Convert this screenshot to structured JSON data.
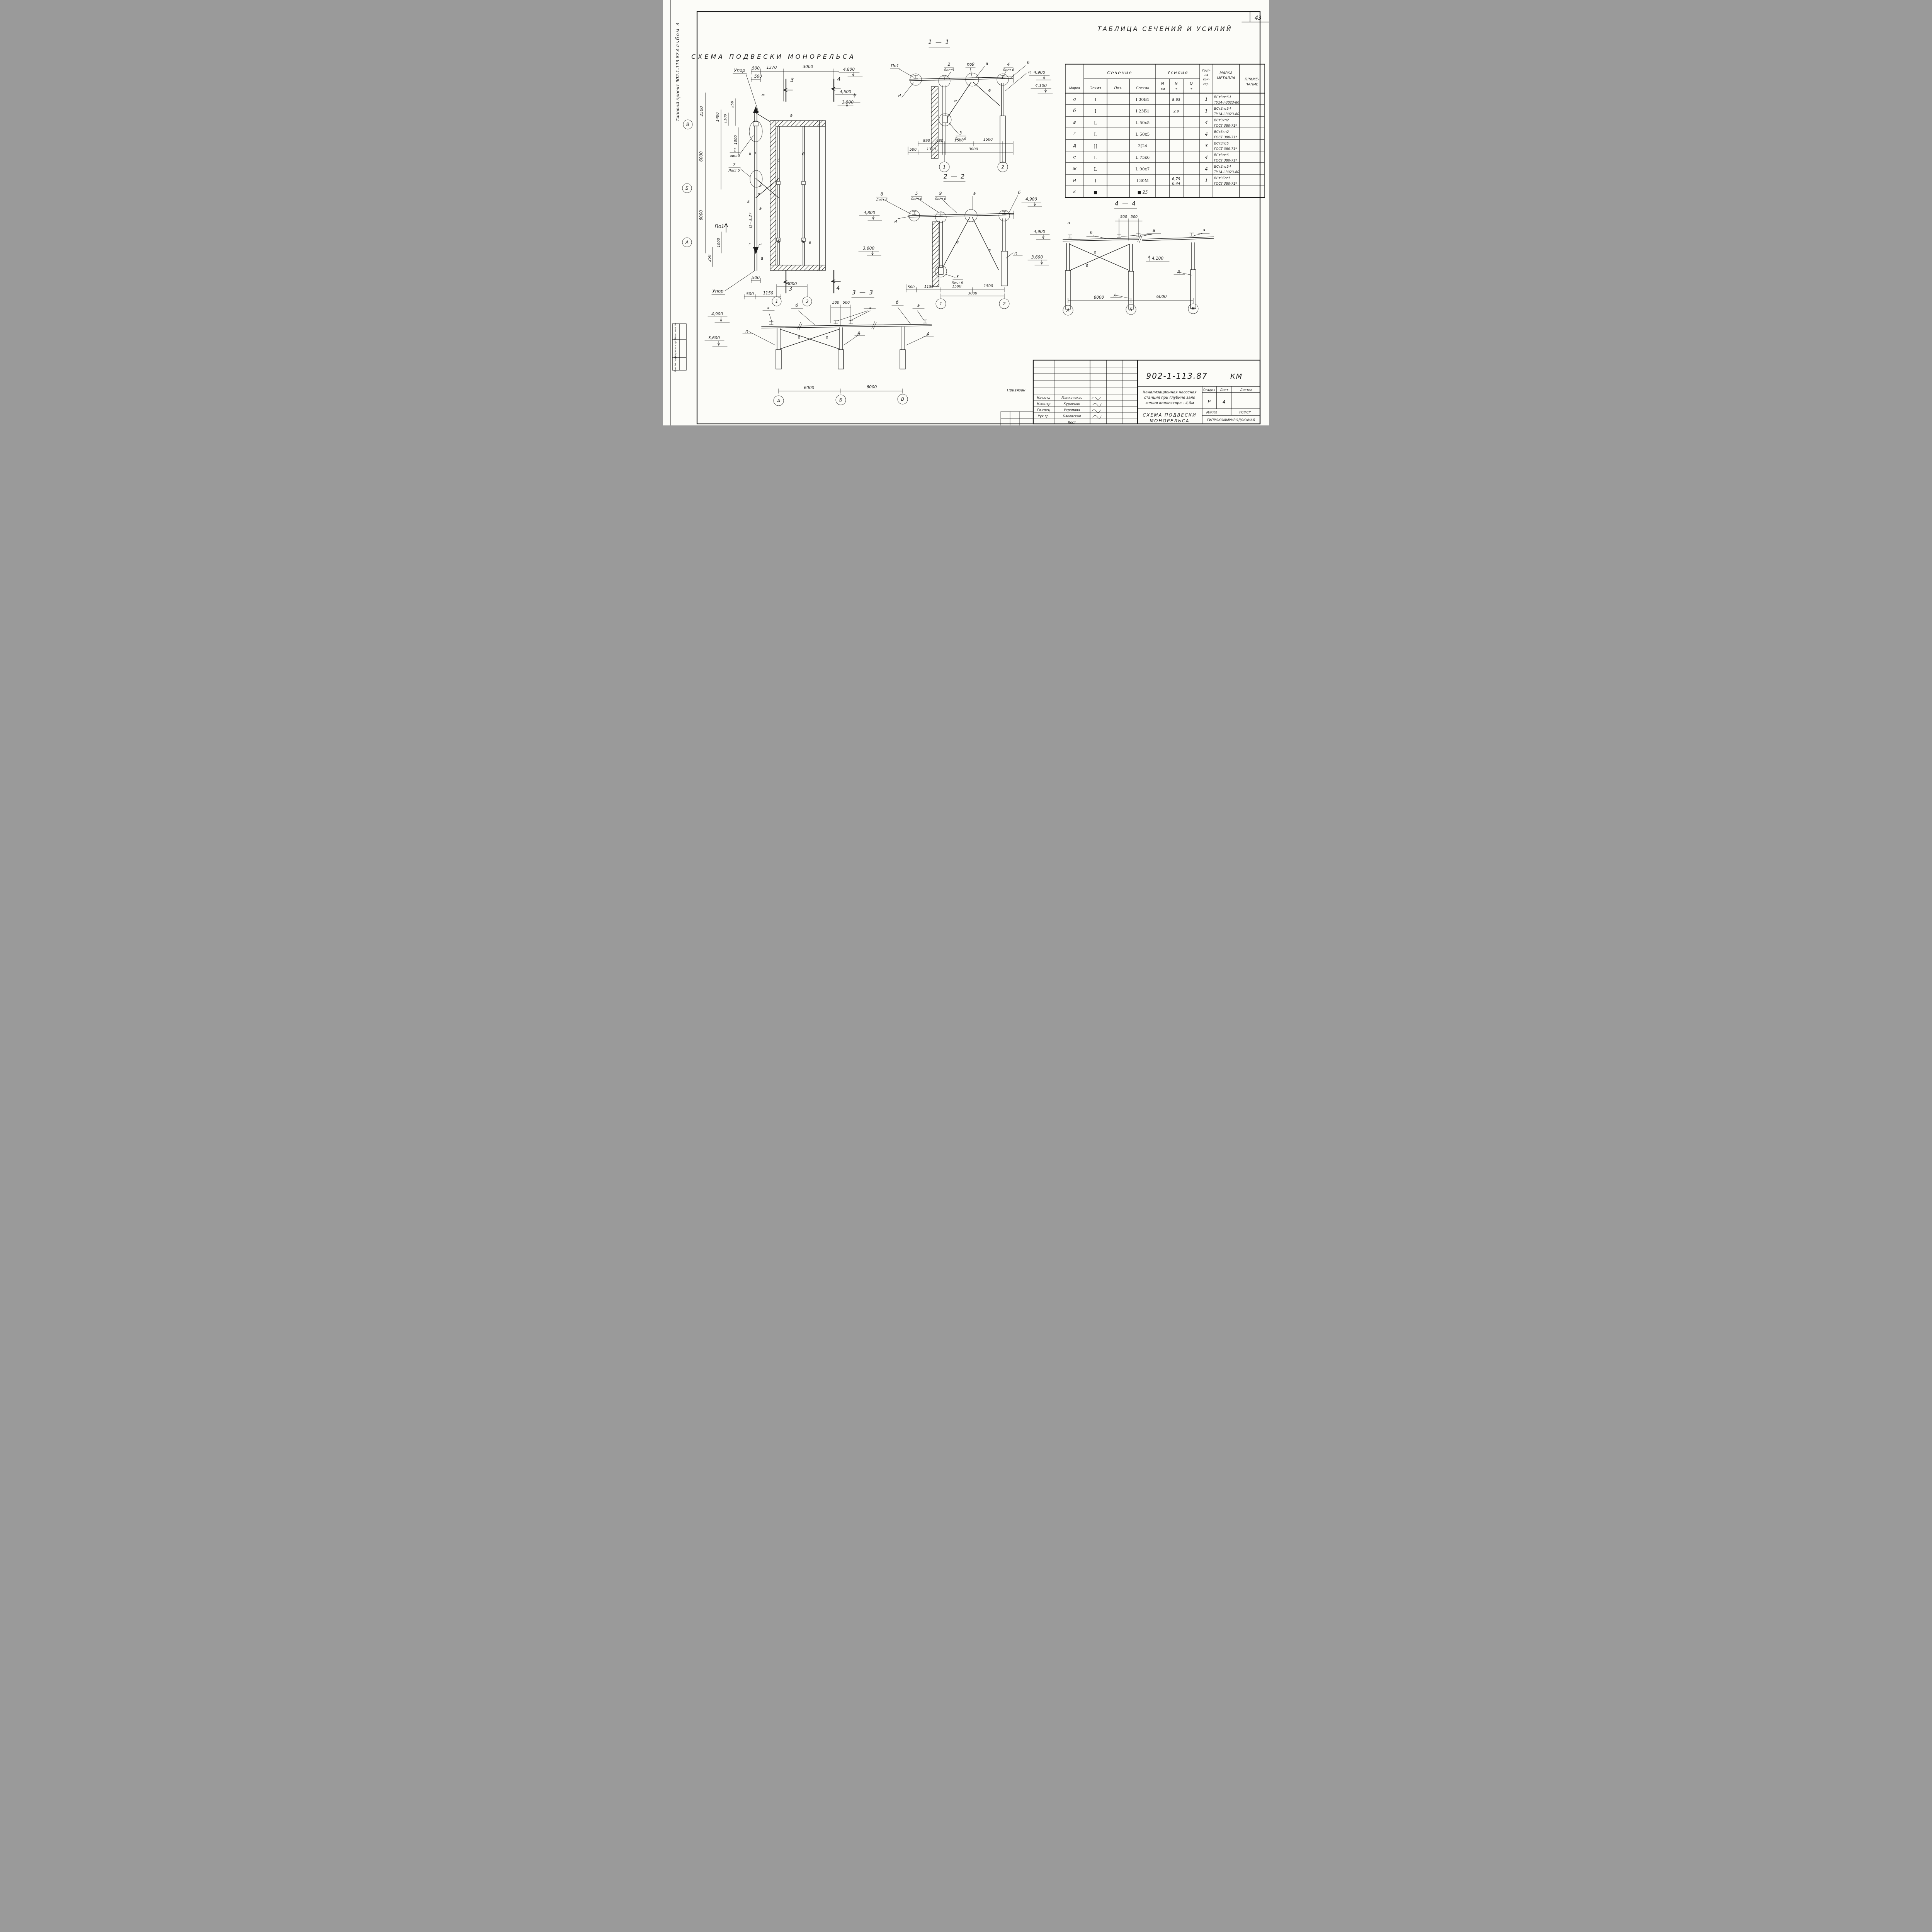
{
  "page": {
    "sheet_number": "43"
  },
  "side": {
    "project": "Типовой проект 902-1-113.87",
    "album": "Альбом 3",
    "stamp_cells": [
      "Взам. инв. №",
      "Подпись и дата",
      "Инв. № подл."
    ]
  },
  "table": {
    "title": "ТАБЛИЦА СЕЧЕНИЙ И УСИЛИЙ",
    "headers": {
      "marka": "Марка",
      "sechenie": "Сечение",
      "usiliya": "Усилия",
      "eskiz": "Эскиз",
      "poz": "Поз.",
      "sostav": "Состав",
      "m": "М",
      "m_u": "тм",
      "n": "N",
      "n_u": "т",
      "q": "Q",
      "q_u": "т",
      "grp1": "Груп-",
      "grp2": "па",
      "grp3": "кон-",
      "grp4": "стр.",
      "metal1": "МАРКА",
      "metal2": "МЕТАЛЛА",
      "note1": "ПРИМЕ-",
      "note2": "ЧАНИЕ"
    },
    "rows": [
      {
        "marka": "а",
        "sketch": "I",
        "poz": "",
        "sostav": "I 30Б1",
        "m": "",
        "n1": "8,63",
        "n2": "",
        "q": "",
        "grp": "1",
        "metal": "ВСт3пс6-I",
        "std": "ТУ14-I-3023-80"
      },
      {
        "marka": "б",
        "sketch": "I",
        "poz": "",
        "sostav": "I 23Б1",
        "m": "",
        "n1": "2,9",
        "n2": "",
        "q": "",
        "grp": "1",
        "metal": "ВСт3пс6-I",
        "std": "ТУ14-I-3023-80"
      },
      {
        "marka": "в",
        "sketch": "L",
        "poz": "",
        "sostav": "L 50x5",
        "m": "",
        "n1": "",
        "n2": "",
        "q": "",
        "grp": "4",
        "metal": "ВСт3кп2",
        "std": "ГОСТ 380-71*"
      },
      {
        "marka": "г",
        "sketch": "L",
        "poz": "",
        "sostav": "L 50x5",
        "m": "",
        "n1": "",
        "n2": "",
        "q": "",
        "grp": "4",
        "metal": "ВСт3кп2",
        "std": "ГОСТ 380-71*"
      },
      {
        "marka": "д",
        "sketch": "[]",
        "poz": "",
        "sostav": "2[24",
        "m": "",
        "n1": "",
        "n2": "",
        "q": "",
        "grp": "3",
        "metal": "ВСт3пс6",
        "std": "ГОСТ 380-71*"
      },
      {
        "marka": "е",
        "sketch": "L",
        "poz": "",
        "sostav": "L 75x6",
        "m": "",
        "n1": "",
        "n2": "",
        "q": "",
        "grp": "4",
        "metal": "ВСт3пс6",
        "std": "ГОСТ 380-71*"
      },
      {
        "marka": "ж",
        "sketch": "L",
        "poz": "",
        "sostav": "L 90x7",
        "m": "",
        "n1": "",
        "n2": "",
        "q": "",
        "grp": "4",
        "metal": "ВСт3пс6-I",
        "std": "ТУ14-I-3023-80"
      },
      {
        "marka": "и",
        "sketch": "I",
        "poz": "",
        "sostav": "I 30М",
        "m": "",
        "n1": "6,79",
        "n2": "0,44",
        "q": "",
        "grp": "1",
        "metal": "ВСт3Гпс5",
        "std": "ГОСТ 380-71*"
      },
      {
        "marka": "к",
        "sketch": "■",
        "poz": "",
        "sostav": "■ 25",
        "m": "",
        "n1": "",
        "n2": "",
        "q": "",
        "grp": "",
        "metal": "",
        "std": ""
      }
    ]
  },
  "plan": {
    "title": "СХЕМА ПОДВЕСКИ МОНОРЕЛЬСА",
    "upor": "Упор",
    "po1": "По1",
    "q": "Q=3,2т",
    "det1n": "1",
    "det1l": "лист5",
    "det7n": "7",
    "det7l": "Лист 5",
    "d2500": "2500",
    "d1400": "1400",
    "d1100": "1100",
    "d250": "250",
    "d1000": "1000",
    "d6000": "6000",
    "d500": "500",
    "d1370": "1370",
    "d3000": "3000",
    "d1150": "1150",
    "m3": "3",
    "m4": "4",
    "la": "а",
    "lb": "б",
    "lv": "в",
    "lg": "г",
    "lg2": "г'",
    "le": "е",
    "li": "и",
    "lk": "к",
    "lzh": "ж",
    "axA": "А",
    "axB": "Б",
    "axV": "В",
    "ax1": "1",
    "ax2": "2"
  },
  "s11": {
    "t": "1 — 1",
    "po1": "По1",
    "n2": "2",
    "l5": "Лист5",
    "po9": "по9",
    "la": "а",
    "n4": "4",
    "l6": "Лист 6",
    "lb": "б",
    "ld": "д",
    "li": "и",
    "le": "е",
    "n3": "3",
    "e48": "4,800",
    "e45": "4,500",
    "e35": "3,500",
    "e49": "4,900",
    "e41": "4,100",
    "d890": "890",
    "d480": "480",
    "d1500": "1500",
    "d500": "500",
    "d1370": "1370",
    "d3000": "3000",
    "ax1": "1",
    "ax2": "2"
  },
  "s22": {
    "t": "2 — 2",
    "n8": "8",
    "n5": "5",
    "n9": "9",
    "l6": "Лист 6",
    "la": "а",
    "lb": "б",
    "li": "и",
    "ld": "д",
    "le": "е",
    "n3": "3",
    "e48": "4,800",
    "e36": "3,600",
    "e49": "4,900",
    "d500": "500",
    "d1150": "1150",
    "d1500": "1500",
    "d3000": "3000",
    "ax1": "1",
    "ax2": "2"
  },
  "s33": {
    "t": "3 — 3",
    "e49": "4,900",
    "e36": "3,600",
    "la": "а",
    "lb": "б",
    "ld": "д",
    "le": "е",
    "d500": "500",
    "d6000": "6000",
    "axA": "А",
    "axB": "Б",
    "axV": "В"
  },
  "s44": {
    "t": "4 — 4",
    "e49": "4,900",
    "e36": "3,600",
    "e41": "4,100",
    "la": "а",
    "lb": "б",
    "ld": "д",
    "le": "е",
    "d500": "500",
    "d6000": "6000",
    "axA": "А",
    "axB": "Б",
    "axV": "В"
  },
  "stamp": {
    "doc_number": "902-1-113.87",
    "doc_type": "КМ",
    "proj1": "Канализационная насосная",
    "proj2": "станция при глубине зало",
    "proj3": "жения коллектора - 4,0м",
    "stage_label": "Стадия",
    "sheet_label": "Лист",
    "sheets_label": "Листов",
    "stage": "Р",
    "sheet": "4",
    "sheets": "",
    "title1": "СХЕМА ПОДВЕСКИ",
    "title2": "МОНОРЕЛЬСА",
    "org_l": "МЖКХ",
    "org_r": "РСФСР",
    "org": "ГИПРОКОММУНВОДОКАНАЛ",
    "note": "Привязан",
    "people": [
      {
        "role": "Нач.отд",
        "name": "Манкачекас"
      },
      {
        "role": "Н.контр",
        "name": "Курленко"
      },
      {
        "role": "Гл.спец",
        "name": "Укропова"
      },
      {
        "role": "Рук.гр.",
        "name": "Бяковская"
      },
      {
        "role": "",
        "name": "Кост"
      }
    ]
  }
}
